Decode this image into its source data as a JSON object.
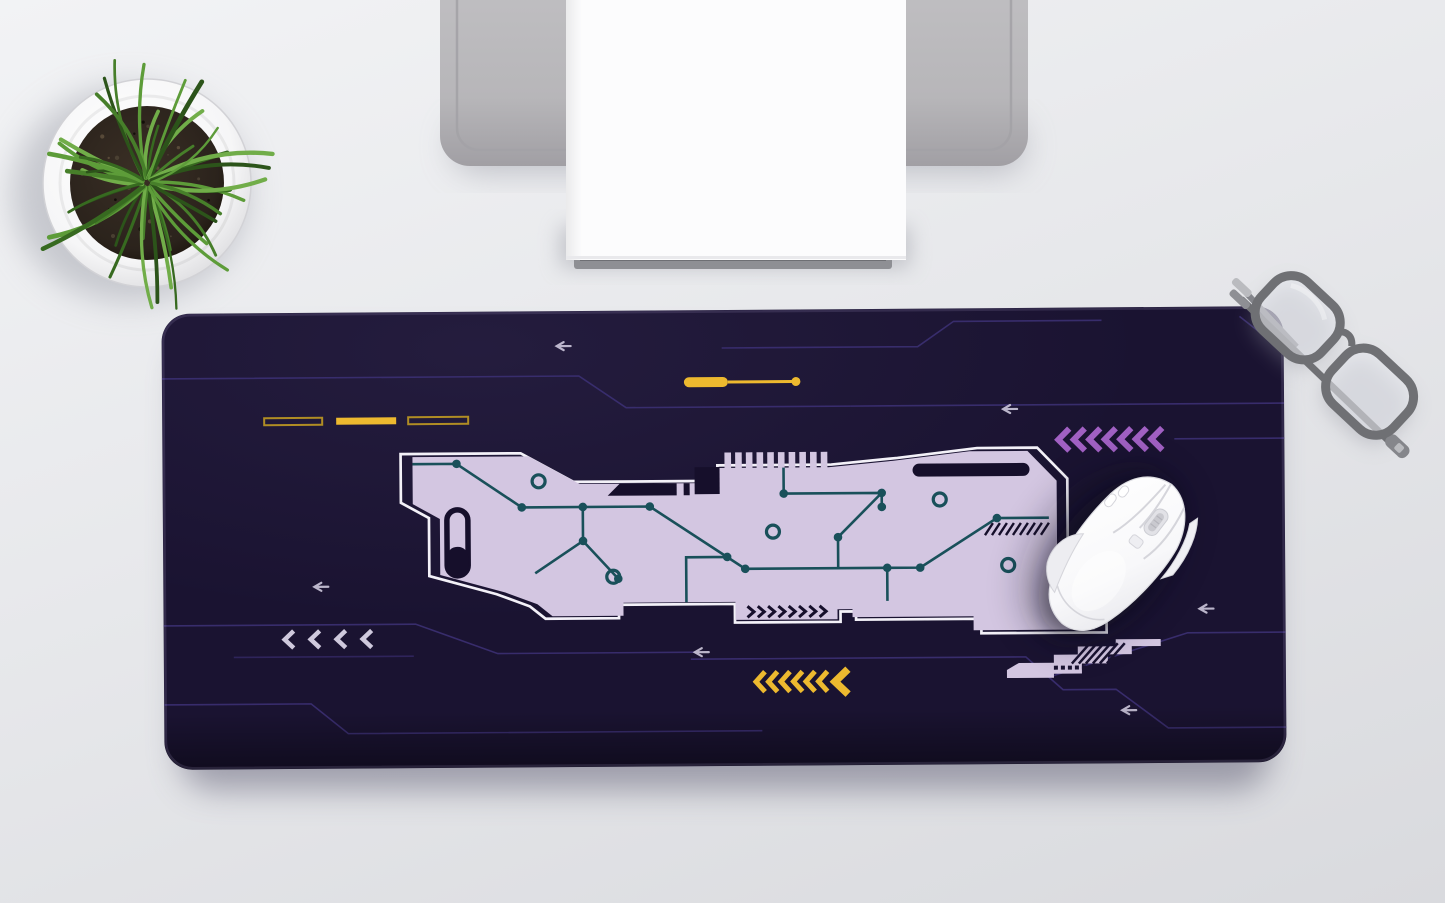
{
  "scene": {
    "title": "Top-down desk scene with printed gaming desk mat",
    "objects": {
      "desk_surface": "Light gray desk surface",
      "desk_mat": "Dark purple extended desk mat with sci-fi circuit-board print",
      "mouse": "White wireless gaming mouse resting on right side of mat",
      "printer": "Gray printer with white paper sheet at top center",
      "plant": "Round white pot with grass plant at top left",
      "glasses": "Folded gray eyeglasses at top-right corner of mat"
    }
  },
  "colors": {
    "desk_top": "#f2f3f5",
    "desk_mid": "#e7e8eb",
    "desk_bottom": "#d9dade",
    "mat_base": "#1a1331",
    "print_lavender": "#d3c6e1",
    "print_outline": "#f3f1f8",
    "print_teal": "#19505a",
    "print_dark": "#160f2b",
    "line_purple": "#3a2e70",
    "arrow_gray": "#cdc8dc",
    "yellow": "#edb92f",
    "yellow_dim": "#b08d24",
    "chevron_purple": "#a160c3",
    "chevron_light": "#cfc9dd",
    "pot_white": "#f6f6f7",
    "pot_edge": "#d9d9dc",
    "soil": "#2b231c",
    "soil_dark": "#171009",
    "printer_gray": "#b7b6b9",
    "printer_gray_dark": "#a19fa4",
    "paper": "#fcfcfd",
    "tray_gray": "#8e8f94",
    "mouse_white": "#f8f8fa",
    "mouse_shade": "#e6e6eb",
    "mouse_line": "#d5d5db",
    "glasses_frame": "#6f7074",
    "glasses_metal": "#babbbf",
    "glasses_lens": "rgba(234,235,240,0.55)",
    "grass": [
      "#5d9c39",
      "#477f2a",
      "#376a20",
      "#71ad49",
      "#2c541a"
    ]
  },
  "mat_print": {
    "dash_row": {
      "count": 3,
      "styles": [
        "outline",
        "filled",
        "outline"
      ]
    },
    "pin_bar": {
      "has_tail_dot": true
    },
    "purple_chevrons": {
      "count": 7,
      "direction": "left"
    },
    "yellow_chevrons": {
      "count": 7,
      "direction": "left",
      "last_larger": true
    },
    "light_chevrons": {
      "count": 4,
      "direction": "left"
    },
    "strip_chevrons": {
      "count": 8,
      "direction": "right"
    },
    "comb_teeth": {
      "count": 10
    },
    "circuit_dots": {
      "count": 15
    },
    "circuit_rings": {
      "count": 5
    },
    "arrows": {
      "count": 6,
      "direction": "left"
    },
    "staircase_dots": {
      "count": 5
    }
  },
  "plant": {
    "blade_count": 42,
    "speckle_count": 24
  }
}
